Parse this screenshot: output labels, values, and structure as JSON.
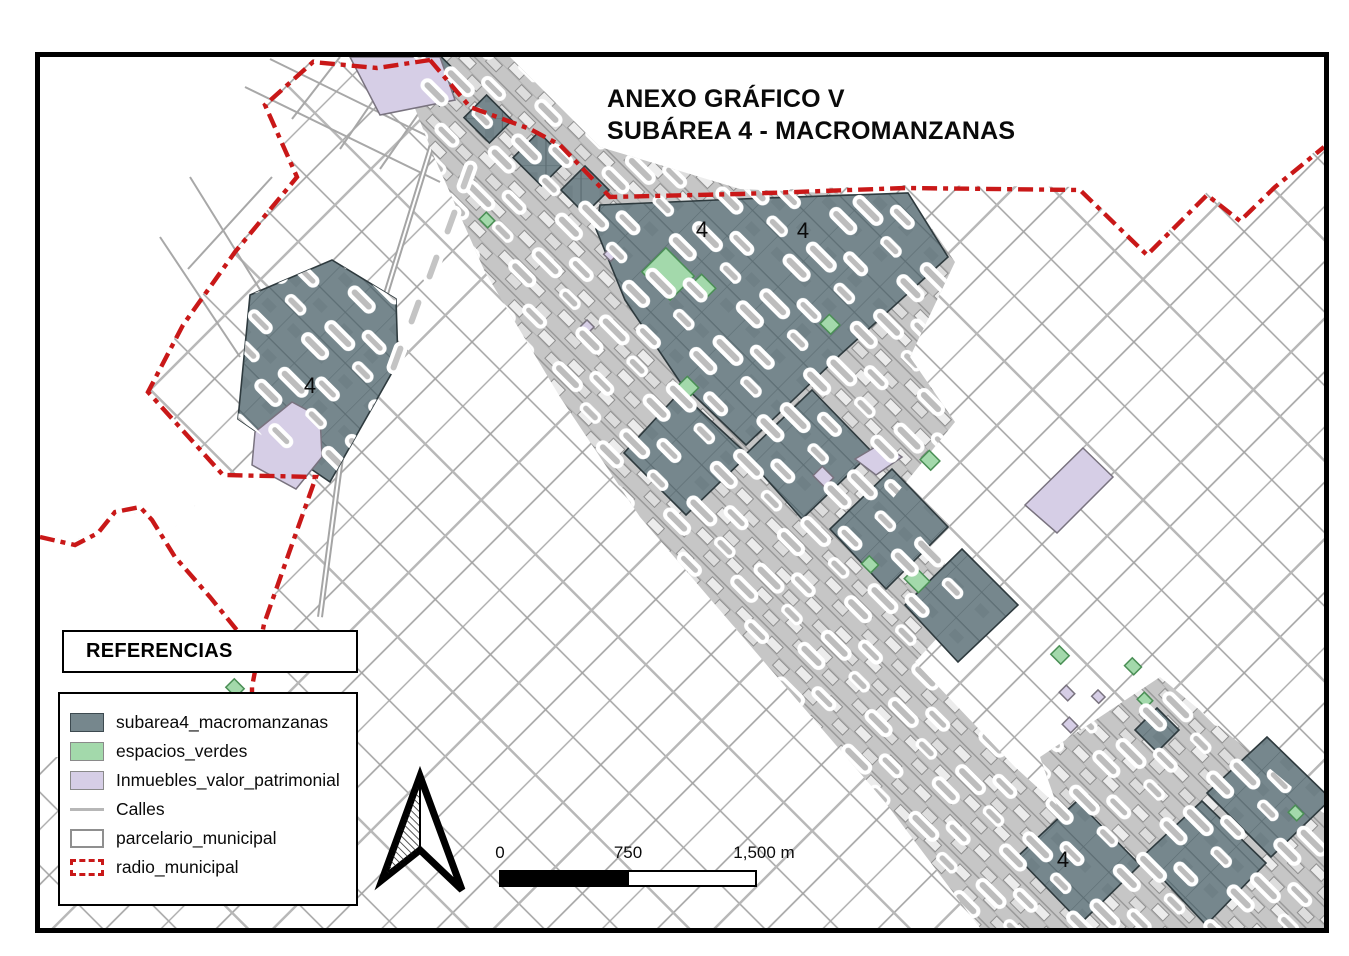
{
  "map": {
    "title_line1": "ANEXO GRÁFICO V",
    "title_line2": "SUBÁREA 4 - MACROMANZANAS",
    "area_labels": [
      "4",
      "4",
      "4",
      "4"
    ]
  },
  "legend": {
    "title": "REFERENCIAS",
    "items": [
      {
        "label": "subarea4_macromanzanas"
      },
      {
        "label": "espacios_verdes"
      },
      {
        "label": "Inmuebles_valor_patrimonial"
      },
      {
        "label": "Calles"
      },
      {
        "label": "parcelario_municipal"
      },
      {
        "label": "radio_municipal"
      }
    ]
  },
  "scalebar": {
    "labels": [
      "0",
      "750",
      "1,500 m"
    ]
  },
  "colors": {
    "frame": "#000000",
    "macromanzanas_fill": "#76878d",
    "macromanzanas_stroke": "#2e3a3e",
    "espacios_fill": "#a3d9ab",
    "espacios_stroke": "#4a8f55",
    "inmuebles_fill": "#d6cee6",
    "inmuebles_stroke": "#79737f",
    "calles": "#b7b7b7",
    "parcel_stroke": "#a2a2a2",
    "radio_municipal": "#c91818",
    "dense_urban": "#c6c6c6"
  }
}
